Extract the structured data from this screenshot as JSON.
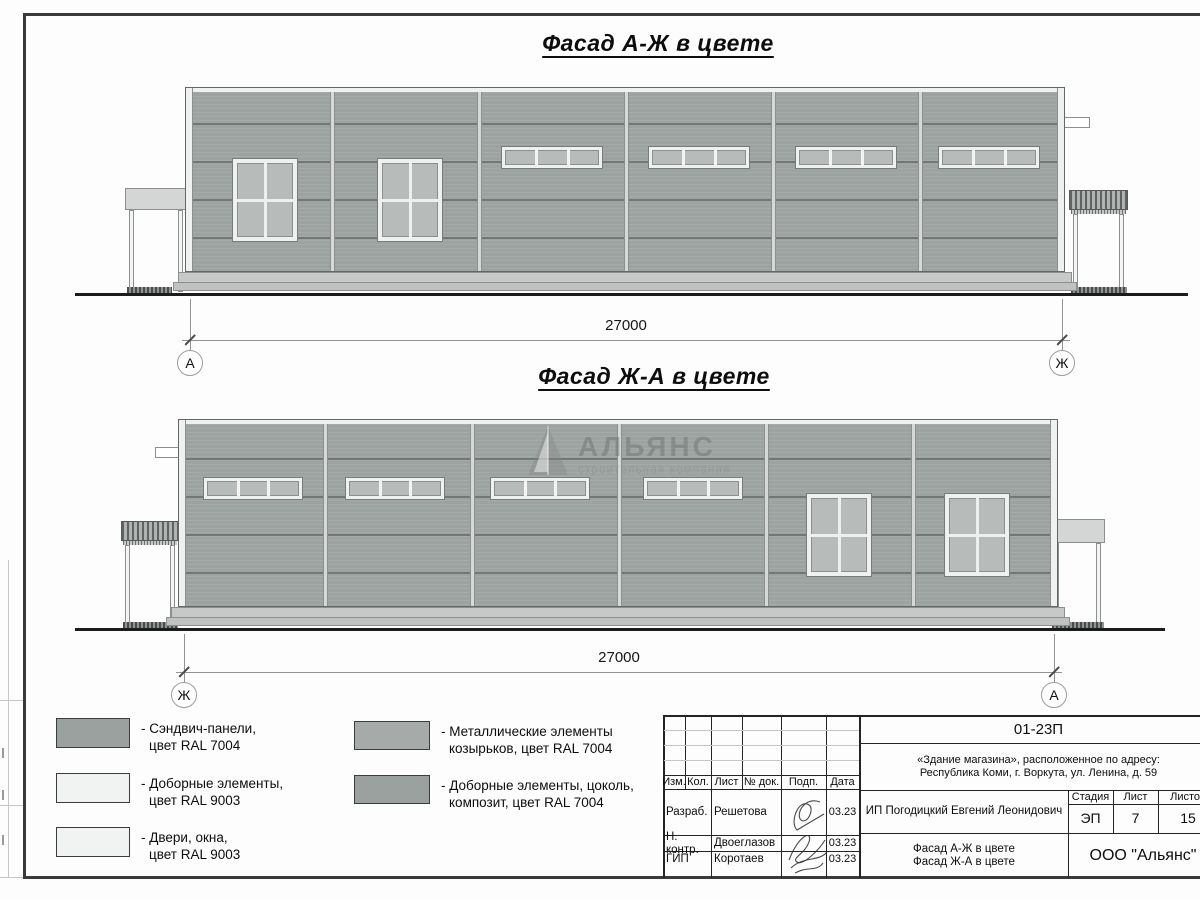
{
  "titles": {
    "facade1": "Фасад А-Ж в цвете",
    "facade2": "Фасад Ж-А в цвете"
  },
  "watermark": {
    "name": "АЛЬЯНС",
    "subtitle": "строительная компания"
  },
  "legend": [
    {
      "swatch": "#9ba19f",
      "line1": "- Сэндвич-панели,",
      "line2": "цвет RAL 7004"
    },
    {
      "swatch": "#f1f3f2",
      "line1": "- Доборные элементы,",
      "line2": "цвет RAL 9003"
    },
    {
      "swatch": "#f1f3f2",
      "line1": "- Двери, окна,",
      "line2": "цвет RAL 9003"
    },
    {
      "swatch": "#a6aba9",
      "line1": "- Металлические элементы",
      "line2": "козырьков, цвет RAL 7004"
    },
    {
      "swatch": "#9ba19f",
      "line1": "- Доборные элементы, цоколь,",
      "line2": "композит, цвет RAL 7004"
    }
  ],
  "titleblock": {
    "code": "01-23П",
    "address1": "«Здание магазина», расположенное по адресу:",
    "address2": "Республика Коми, г. Воркута, ул. Ленина, д. 59",
    "cols": {
      "izm": "Изм.",
      "kol": "Кол.",
      "list": "Лист",
      "doc": "№ док.",
      "podp": "Подп.",
      "data": "Дата"
    },
    "rows": {
      "r1_role": "Разраб.",
      "r1_name": "Решетова",
      "r1_date": "03.23",
      "r2_role": "Н. контр.",
      "r2_name": "Двоеглазов",
      "r2_date": "03.23",
      "r3_role": "ГИП",
      "r3_name": "Коротаев",
      "r3_date": "03.23"
    },
    "client": "ИП Погодицкий Евгений Леонидович",
    "stage_label": "Стадия",
    "sheet_label": "Лист",
    "sheets_label": "Листов",
    "stage": "ЭП",
    "sheet": "7",
    "sheets": "15",
    "subject1": "Фасад А-Ж в цвете",
    "subject2": "Фасад Ж-А в цвете",
    "org": "ООО \"Альянс\""
  },
  "drawing": {
    "dim_label": "27000",
    "facades": [
      {
        "id": "facade-1",
        "x": 185,
        "w": 880,
        "top": 87,
        "wall_h": 185,
        "joints_rel": [
          147,
          294,
          441,
          588,
          735
        ],
        "hlines_rel": [
          36,
          74,
          112,
          150
        ],
        "strip_windows": {
          "y_rel": 59,
          "w": 102,
          "h": 23,
          "xs_rel": [
            316,
            463,
            610,
            753
          ]
        },
        "big_windows": {
          "y_rel": 71,
          "w": 66,
          "h": 84,
          "xs_rel": [
            47,
            192
          ]
        },
        "canopies": [
          {
            "x": 125,
            "w": 62,
            "roof_top": 188,
            "roof_h": 22,
            "hatched": false,
            "step": [
              127,
              45
            ]
          },
          {
            "x": 1069,
            "w": 59,
            "roof_top": 190,
            "roof_h": 20,
            "hatched": true,
            "step": [
              1071,
              56
            ]
          }
        ],
        "protrusion": {
          "x": 1063,
          "y": 117,
          "w": 27,
          "h": 11
        },
        "ground_y": 293,
        "ground_x1": 75,
        "ground_x2": 1188,
        "dim": {
          "line_y": 340,
          "x1": 190,
          "x2": 1062,
          "label_y": 317,
          "circle_y": 350,
          "left": "А",
          "right": "Ж"
        }
      },
      {
        "id": "facade-2",
        "x": 178,
        "w": 880,
        "top": 419,
        "wall_h": 188,
        "joints_rel": [
          147,
          294,
          441,
          588,
          735
        ],
        "hlines_rel": [
          39,
          77,
          115,
          153
        ],
        "strip_windows": {
          "y_rel": 58,
          "w": 100,
          "h": 23,
          "xs_rel": [
            25,
            167,
            312,
            465
          ]
        },
        "big_windows": {
          "y_rel": 74,
          "w": 66,
          "h": 84,
          "xs_rel": [
            628,
            766
          ]
        },
        "canopies": [
          {
            "x": 121,
            "w": 58,
            "roof_top": 521,
            "roof_h": 20,
            "hatched": true,
            "step": [
              123,
              55
            ]
          },
          {
            "x": 1050,
            "w": 55,
            "roof_top": 519,
            "roof_h": 24,
            "hatched": false,
            "step": [
              1052,
              52
            ]
          }
        ],
        "protrusion": {
          "x": 155,
          "y": 447,
          "w": 27,
          "h": 11
        },
        "ground_y": 628,
        "ground_x1": 75,
        "ground_x2": 1165,
        "dim": {
          "line_y": 672,
          "x1": 184,
          "x2": 1054,
          "label_y": 649,
          "circle_y": 682,
          "left": "Ж",
          "right": "А"
        }
      }
    ]
  }
}
